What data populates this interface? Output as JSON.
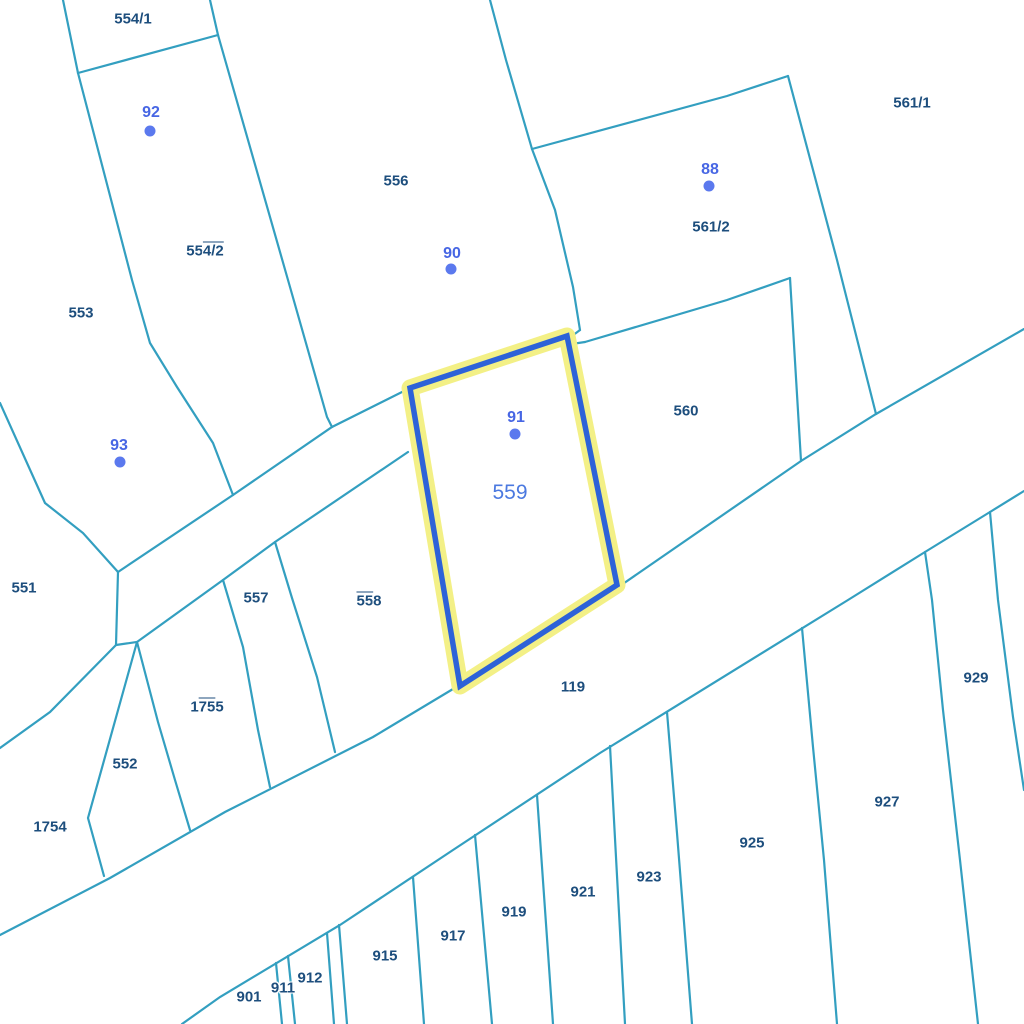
{
  "map": {
    "colors": {
      "background": "#ffffff",
      "parcel_line": "#339fc0",
      "parcel_label": "#1d4e7d",
      "marker_text": "#4766e4",
      "marker_dot": "#5b79ee",
      "selected_label": "#4b79e0",
      "highlight_stroke": "#2d62d8",
      "highlight_halo": "#f3f086"
    },
    "selected_parcel": {
      "id": "559",
      "label": {
        "text": "559",
        "x": 510,
        "y": 493
      }
    },
    "parcel_labels": [
      {
        "text": "554/1",
        "pre": "554/1",
        "over": "",
        "post": "",
        "x": 133,
        "y": 19
      },
      {
        "text": "554/2",
        "pre": "55",
        "over": "4/2",
        "post": "",
        "x": 205,
        "y": 251
      },
      {
        "text": "553",
        "pre": "553",
        "over": "",
        "post": "",
        "x": 81,
        "y": 313
      },
      {
        "text": "556",
        "pre": "556",
        "over": "",
        "post": "",
        "x": 396,
        "y": 181
      },
      {
        "text": "561/1",
        "pre": "561/1",
        "over": "",
        "post": "",
        "x": 912,
        "y": 103
      },
      {
        "text": "561/2",
        "pre": "561/2",
        "over": "",
        "post": "",
        "x": 711,
        "y": 227
      },
      {
        "text": "560",
        "pre": "560",
        "over": "",
        "post": "",
        "x": 686,
        "y": 411
      },
      {
        "text": "551",
        "pre": "551",
        "over": "",
        "post": "",
        "x": 24,
        "y": 588
      },
      {
        "text": "557",
        "pre": "557",
        "over": "",
        "post": "",
        "x": 256,
        "y": 598
      },
      {
        "text": "558",
        "pre": "",
        "over": "55",
        "post": "8",
        "x": 369,
        "y": 601
      },
      {
        "text": "119",
        "pre": "119",
        "over": "",
        "post": "",
        "x": 573,
        "y": 687
      },
      {
        "text": "1755",
        "pre": "1",
        "over": "75",
        "post": "5",
        "x": 207,
        "y": 707
      },
      {
        "text": "552",
        "pre": "552",
        "over": "",
        "post": "",
        "x": 125,
        "y": 764
      },
      {
        "text": "1754",
        "pre": "1754",
        "over": "",
        "post": "",
        "x": 50,
        "y": 827
      },
      {
        "text": "929",
        "pre": "929",
        "over": "",
        "post": "",
        "x": 976,
        "y": 678
      },
      {
        "text": "927",
        "pre": "927",
        "over": "",
        "post": "",
        "x": 887,
        "y": 802
      },
      {
        "text": "925",
        "pre": "925",
        "over": "",
        "post": "",
        "x": 752,
        "y": 843
      },
      {
        "text": "923",
        "pre": "923",
        "over": "",
        "post": "",
        "x": 649,
        "y": 877
      },
      {
        "text": "921",
        "pre": "921",
        "over": "",
        "post": "",
        "x": 583,
        "y": 892
      },
      {
        "text": "919",
        "pre": "919",
        "over": "",
        "post": "",
        "x": 514,
        "y": 912
      },
      {
        "text": "917",
        "pre": "917",
        "over": "",
        "post": "",
        "x": 453,
        "y": 936
      },
      {
        "text": "915",
        "pre": "915",
        "over": "",
        "post": "",
        "x": 385,
        "y": 956
      },
      {
        "text": "912",
        "pre": "912",
        "over": "",
        "post": "",
        "x": 310,
        "y": 978
      },
      {
        "text": "911",
        "pre": "911",
        "over": "",
        "post": "",
        "x": 283,
        "y": 988
      },
      {
        "text": "901",
        "pre": "901",
        "over": "",
        "post": "",
        "x": 249,
        "y": 997
      }
    ],
    "survey_points": [
      {
        "label": "92",
        "text_x": 151,
        "text_y": 113,
        "dot_x": 150,
        "dot_y": 131
      },
      {
        "label": "90",
        "text_x": 452,
        "text_y": 254,
        "dot_x": 451,
        "dot_y": 269
      },
      {
        "label": "88",
        "text_x": 710,
        "text_y": 170,
        "dot_x": 709,
        "dot_y": 186
      },
      {
        "label": "93",
        "text_x": 119,
        "text_y": 446,
        "dot_x": 120,
        "dot_y": 462
      },
      {
        "label": "91",
        "text_x": 516,
        "text_y": 418,
        "dot_x": 515,
        "dot_y": 434
      }
    ]
  }
}
